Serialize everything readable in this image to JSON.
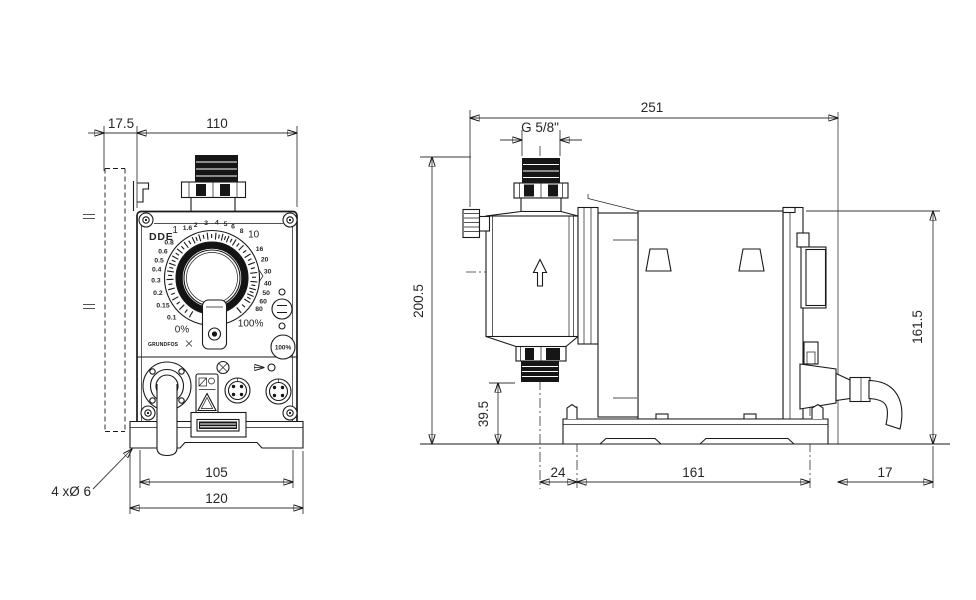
{
  "meta": {
    "drawing_type": "dimensional-drawing",
    "units": "mm"
  },
  "front_view": {
    "model_label": "DDE",
    "brand_logo": "GRUNDFOS",
    "prime_button_label": "100%",
    "dimensions": {
      "bracket_offset": "17.5",
      "housing_width": "110",
      "mounting_hole_spacing": "105",
      "base_width": "120",
      "mounting_holes_note": "4 xØ 6"
    },
    "dial": {
      "scale": [
        {
          "label": "0%",
          "angle": -150,
          "size": "lg"
        },
        {
          "label": "0.1",
          "angle": -134,
          "size": "sm"
        },
        {
          "label": "0.15",
          "angle": -119,
          "size": "sm"
        },
        {
          "label": "0.2",
          "angle": -105,
          "size": "sm"
        },
        {
          "label": "0.3",
          "angle": -92,
          "size": "sm"
        },
        {
          "label": "0.4",
          "angle": -81,
          "size": "sm"
        },
        {
          "label": "0.5",
          "angle": -71,
          "size": "sm"
        },
        {
          "label": "0.6",
          "angle": -61,
          "size": "sm"
        },
        {
          "label": "0.8",
          "angle": -50,
          "size": "sm"
        },
        {
          "label": "1",
          "angle": -38,
          "size": "lg"
        },
        {
          "label": "1.6",
          "angle": -26,
          "size": "sm"
        },
        {
          "label": "2",
          "angle": -17,
          "size": "sm"
        },
        {
          "label": "3",
          "angle": -6,
          "size": "sm"
        },
        {
          "label": "4",
          "angle": 5,
          "size": "sm"
        },
        {
          "label": "5",
          "angle": 14,
          "size": "sm"
        },
        {
          "label": "6",
          "angle": 22,
          "size": "sm"
        },
        {
          "label": "8",
          "angle": 32,
          "size": "sm"
        },
        {
          "label": "10",
          "angle": 44,
          "size": "lg"
        },
        {
          "label": "16",
          "angle": 58,
          "size": "sm"
        },
        {
          "label": "20",
          "angle": 70,
          "size": "sm"
        },
        {
          "label": "30",
          "angle": 83,
          "size": "sm"
        },
        {
          "label": "40",
          "angle": 95,
          "size": "sm"
        },
        {
          "label": "50",
          "angle": 105,
          "size": "sm"
        },
        {
          "label": "60",
          "angle": 114,
          "size": "sm"
        },
        {
          "label": "80",
          "angle": 123,
          "size": "sm"
        },
        {
          "label": "100%",
          "angle": 140,
          "size": "lg"
        }
      ]
    },
    "icons": {
      "display_toggle": "level-bars",
      "warning": "warning-triangle",
      "drain": "flange-with-tube"
    }
  },
  "side_view": {
    "dimensions": {
      "overall_depth": "251",
      "connection_thread": "G 5/8\"",
      "overall_height": "200.5",
      "valve_to_base": "39.5",
      "housing_height": "161.5",
      "head_center_to_foot": "24",
      "foot_spacing": "161",
      "cable_overhang": "17"
    },
    "icons": {
      "flow_direction": "arrow-up"
    }
  }
}
